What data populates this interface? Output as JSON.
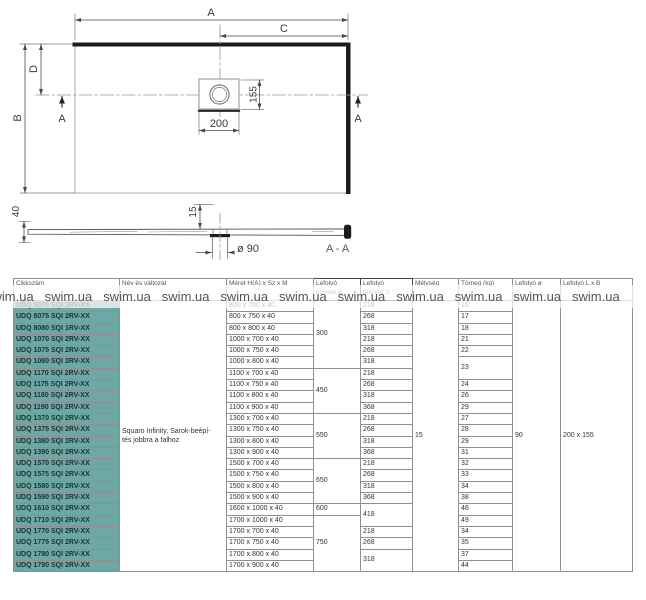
{
  "drawing": {
    "dim_a": "A",
    "dim_b": "B",
    "dim_c": "C",
    "dim_d": "D",
    "dim_155": "155",
    "dim_200": "200",
    "cut_left": "A",
    "cut_right": "A",
    "dim_40": "40",
    "dim_15": "15",
    "drain_dia_label": "ø 90",
    "section_label": "A - A"
  },
  "watermark": {
    "text": "swim.ua"
  },
  "table": {
    "headers": [
      "Cikkszám",
      "Név és változat",
      "Méret H(A) x Sz x M",
      "Lefolyó\nmérete C",
      "Lefolyó\nmérete D",
      "Mélység",
      "Tömeg (kg)",
      "Lefolyó ø",
      "Lefolyó L x B"
    ],
    "name_variant": "Squaro Infinity, Sarok-beépí-\ntés jobbra a falhoz",
    "melyseg": "15",
    "drain_dia": "90",
    "drain_lxb": "200 x 155",
    "rows": [
      {
        "sku": "UDQ 8070 SQI 2RV-XX",
        "size": "800 x 700 x 40"
      },
      {
        "sku": "UDQ 8075 SQI 2RV-XX",
        "size": "800 x 750 x 40"
      },
      {
        "sku": "UDQ 8080 SQI 1RV-XX",
        "size": "800 x 800 x 40"
      },
      {
        "sku": "UDQ 1070 SQI 2RV-XX",
        "size": "1000 x 700 x 40"
      },
      {
        "sku": "UDQ 1075 SQI 2RV-XX",
        "size": "1000 x 750 x 40"
      },
      {
        "sku": "UDQ 1080 SQI 2RV-XX",
        "size": "1000 x 800 x 40"
      },
      {
        "sku": "UDQ 1170 SQI 2RV-XX",
        "size": "1100 x 700 x 40"
      },
      {
        "sku": "UDQ 1175 SQI 2RV-XX",
        "size": "1100 x 750 x 40"
      },
      {
        "sku": "UDQ 1180 SQI 2RV-XX",
        "size": "1100 x 800 x 40"
      },
      {
        "sku": "UDQ 1190 SQI 2RV-XX",
        "size": "1100 x 900 x 40"
      },
      {
        "sku": "UDQ 1370 SQI 2RV-XX",
        "size": "1300 x 700 x 40"
      },
      {
        "sku": "UDQ 1375 SQI 2RV-XX",
        "size": "1300 x 750 x 40"
      },
      {
        "sku": "UDQ 1380 SQI 2RV-XX",
        "size": "1300 x 800 x 40"
      },
      {
        "sku": "UDQ 1390 SQI 2RV-XX",
        "size": "1300 x 900 x 40"
      },
      {
        "sku": "UDQ 1570 SQI 2RV-XX",
        "size": "1500 x 700 x 40"
      },
      {
        "sku": "UDQ 1575 SQI 2RV-XX",
        "size": "1500 x 750 x 40"
      },
      {
        "sku": "UDQ 1580 SQI 2RV-XX",
        "size": "1500 x 800 x 40"
      },
      {
        "sku": "UDQ 1590 SQI 2RV-XX",
        "size": "1500 x 900 x 40"
      },
      {
        "sku": "UDQ 1610 SQI 2RV-XX",
        "size": "1600 x 1000 x 40"
      },
      {
        "sku": "UDQ 1710 SQI 2RV-XX",
        "size": "1700 x 1000 x 40"
      },
      {
        "sku": "UDQ 1770 SQI 2RV-XX",
        "size": "1700 x 700 x 40"
      },
      {
        "sku": "UDQ 1775 SQI 2RV-XX",
        "size": "1700 x 750 x 40"
      },
      {
        "sku": "UDQ 1780 SQI 2RV-XX",
        "size": "1700 x 800 x 40"
      },
      {
        "sku": "UDQ 1790 SQI 2RV-XX",
        "size": "1700 x 900 x 40"
      }
    ],
    "c_cells": [
      {
        "v": "300",
        "span": 6
      },
      {
        "v": "450",
        "span": 4
      },
      {
        "v": "550",
        "span": 4
      },
      {
        "v": "650",
        "span": 4
      },
      {
        "v": "600",
        "span": 1
      },
      {
        "v": "750",
        "span": 5
      }
    ],
    "d_cells": [
      {
        "v": "218"
      },
      {
        "v": "268"
      },
      {
        "v": "318"
      },
      {
        "v": "218"
      },
      {
        "v": "268"
      },
      {
        "v": "318"
      },
      {
        "v": "218"
      },
      {
        "v": "268"
      },
      {
        "v": "318"
      },
      {
        "v": "368"
      },
      {
        "v": "218"
      },
      {
        "v": "268"
      },
      {
        "v": "318"
      },
      {
        "v": "368"
      },
      {
        "v": "218"
      },
      {
        "v": "268"
      },
      {
        "v": "318"
      },
      {
        "v": "368"
      },
      {
        "v": "418",
        "span": 2
      },
      {
        "v": "218"
      },
      {
        "v": "268"
      },
      {
        "v": "318",
        "span": 2
      }
    ],
    "weight_cells": [
      {
        "v": "16"
      },
      {
        "v": "17"
      },
      {
        "v": "18"
      },
      {
        "v": "21"
      },
      {
        "v": "22"
      },
      {
        "v": "23",
        "span": 2
      },
      {
        "v": "24"
      },
      {
        "v": "26"
      },
      {
        "v": "29"
      },
      {
        "v": "27"
      },
      {
        "v": "28"
      },
      {
        "v": "29"
      },
      {
        "v": "31"
      },
      {
        "v": "32"
      },
      {
        "v": "33"
      },
      {
        "v": "34"
      },
      {
        "v": "38"
      },
      {
        "v": "46"
      },
      {
        "v": "49"
      },
      {
        "v": "34"
      },
      {
        "v": "35"
      },
      {
        "v": "37"
      },
      {
        "v": "44"
      }
    ],
    "colors": {
      "sku_bg": "#6fa7a5",
      "sku_text": "#143434",
      "border": "#8f8f8f"
    }
  }
}
